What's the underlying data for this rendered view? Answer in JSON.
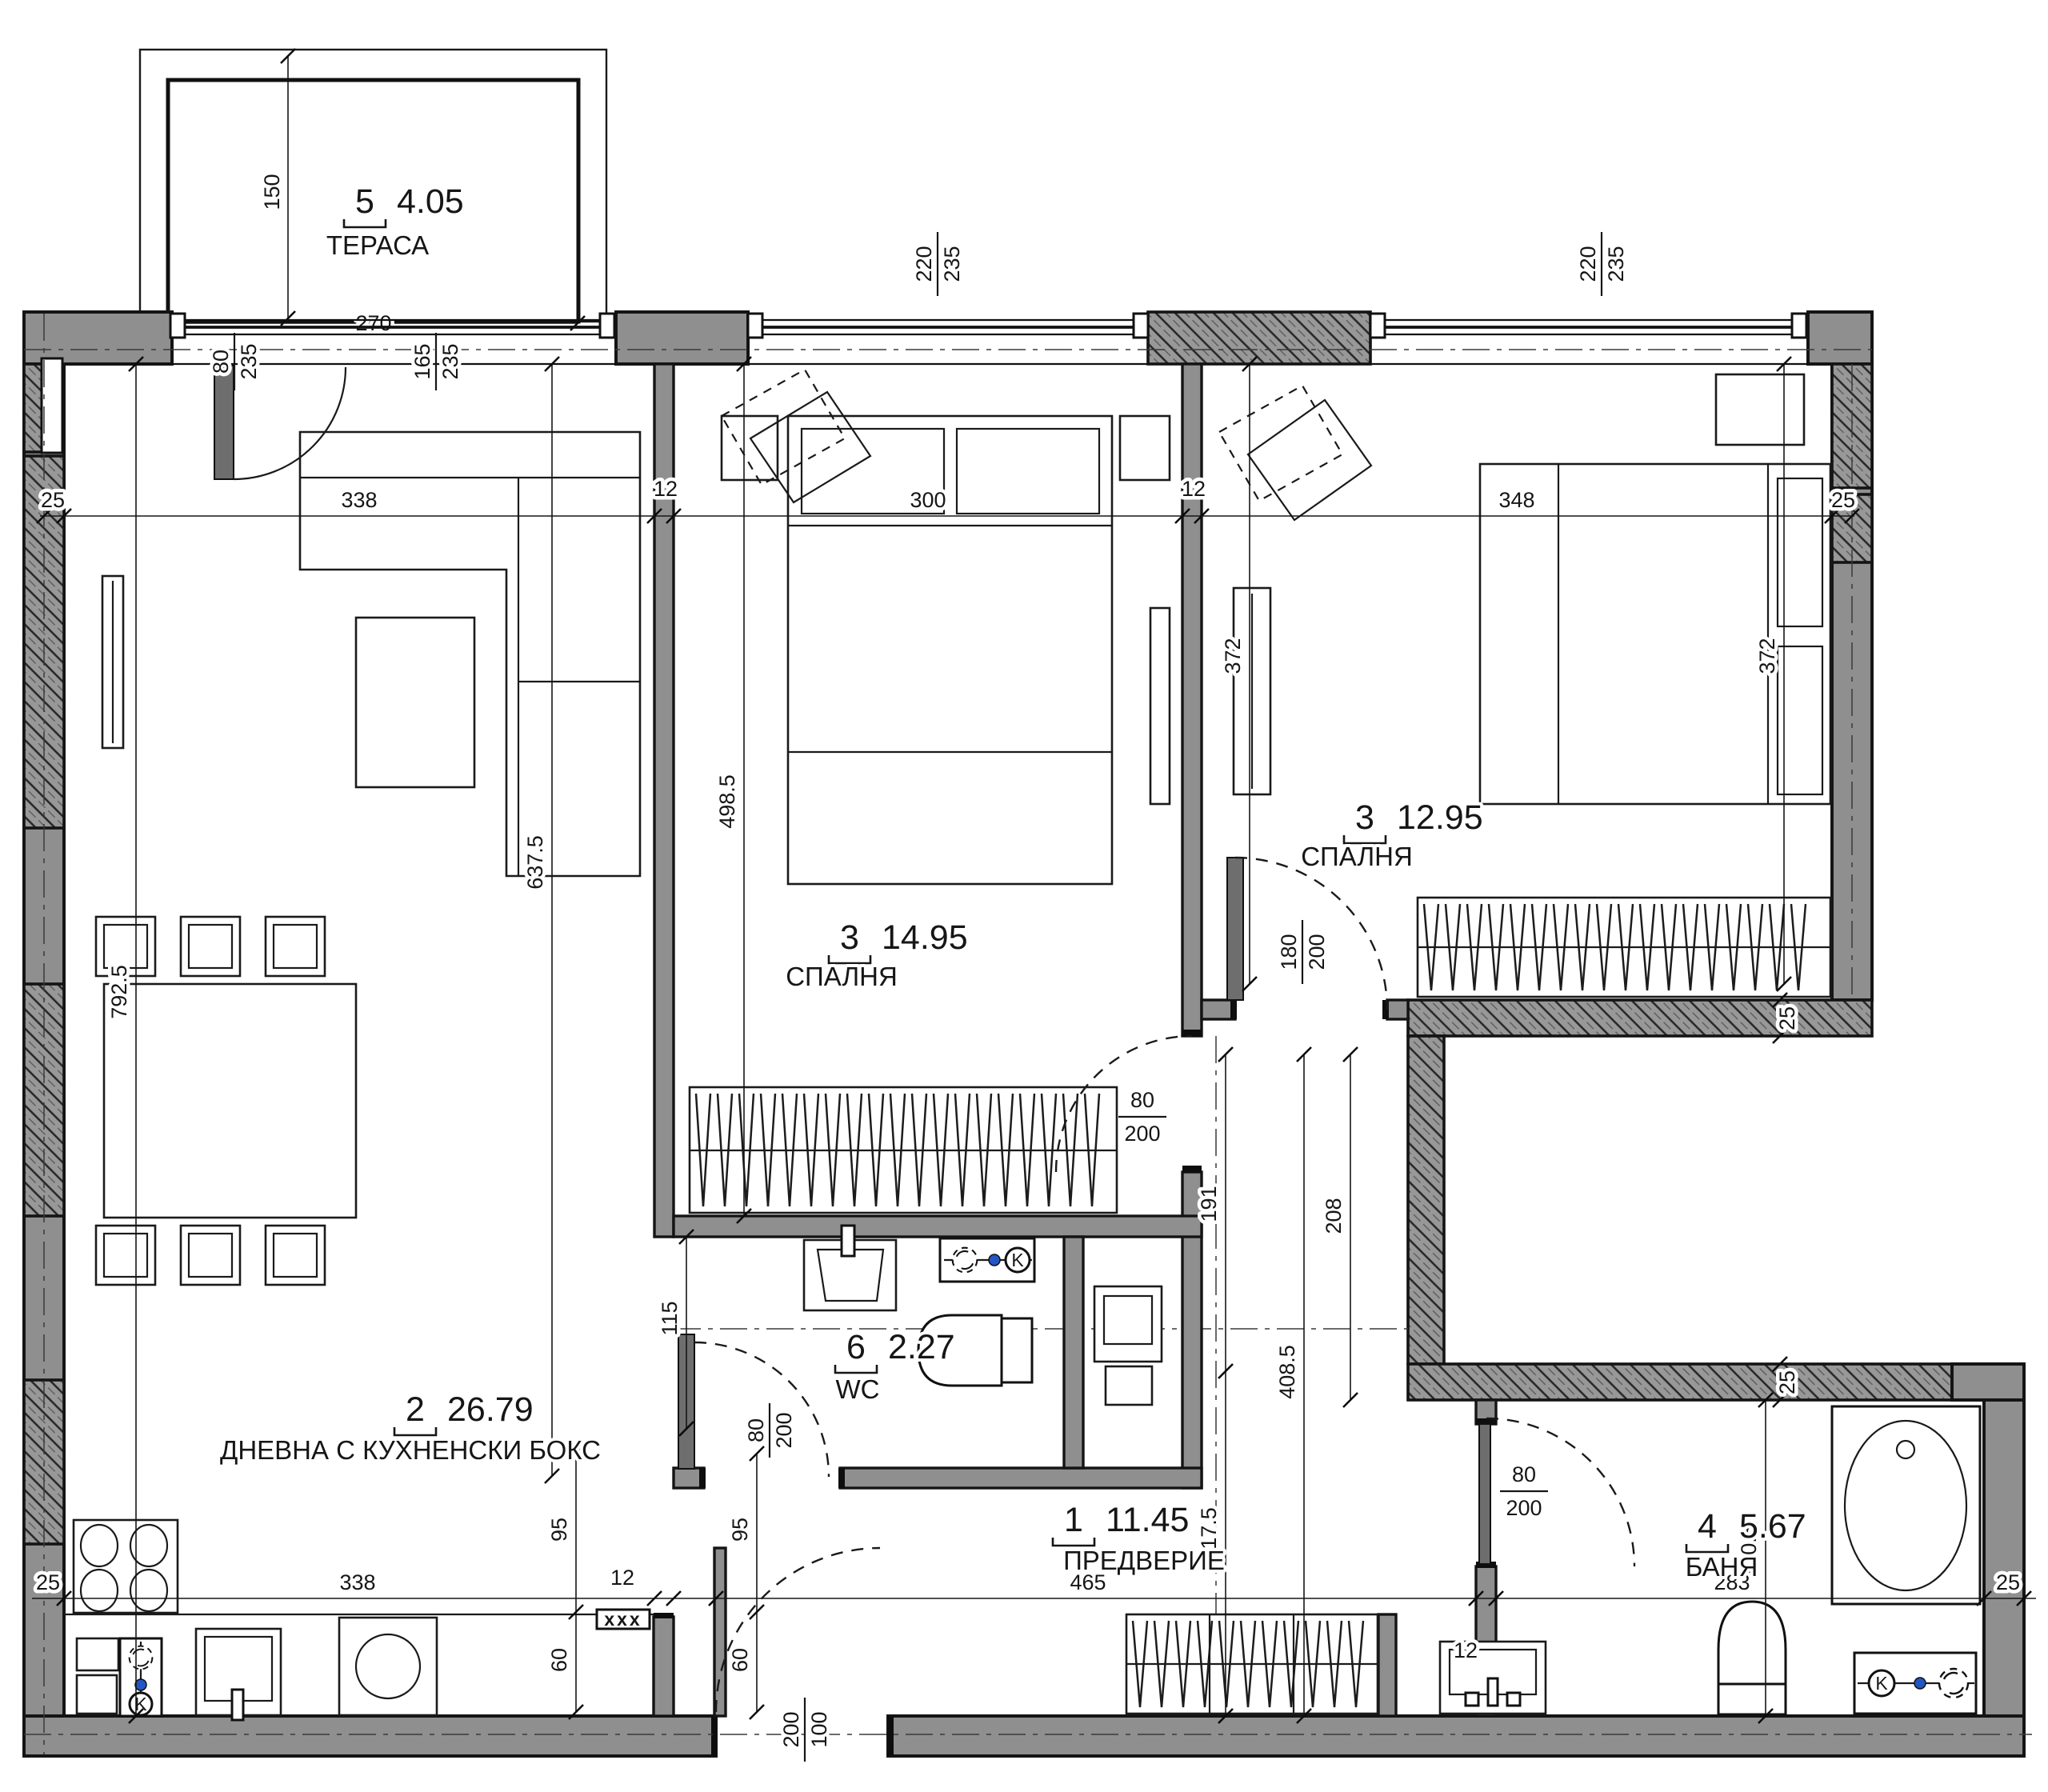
{
  "rooms": {
    "terrace": {
      "number": "5",
      "area": "4.05",
      "name": "ТЕРАСА"
    },
    "living": {
      "number": "2",
      "area": "26.79",
      "name": "ДНЕВНА С КУХНЕНСКИ БОКС"
    },
    "bedroom1": {
      "number": "3",
      "area": "14.95",
      "name": "СПАЛНЯ"
    },
    "bedroom2": {
      "number": "3",
      "area": "12.95",
      "name": "СПАЛНЯ"
    },
    "wc": {
      "number": "6",
      "area": "2.27",
      "name": "WC"
    },
    "hall": {
      "number": "1",
      "area": "11.45",
      "name": "ПРЕДВЕРИЕ"
    },
    "bath": {
      "number": "4",
      "area": "5.67",
      "name": "БАНЯ"
    }
  },
  "dims": {
    "d150": "150",
    "d270": "270",
    "d80": "80",
    "d165": "165",
    "d220": "220",
    "d235": "235",
    "d25": "25",
    "d12": "12",
    "d338": "338",
    "d300": "300",
    "d348": "348",
    "d372": "372",
    "d4985": "498.5",
    "d6375": "637.5",
    "d7925": "792.5",
    "d191": "191",
    "d208": "208",
    "d4085": "408.5",
    "d2175": "217.5",
    "d2005": "200.5",
    "d465": "465",
    "d283": "283",
    "d115": "115",
    "d95": "95",
    "d60": "60",
    "d100": "100",
    "d180": "180",
    "d200": "200",
    "xxx": "xxx",
    "k": "K"
  },
  "colors": {
    "wall_fill": "#8f8f8f",
    "hatch_line": "#262626",
    "line": "#161616",
    "accent_dot": "#2256c4"
  }
}
